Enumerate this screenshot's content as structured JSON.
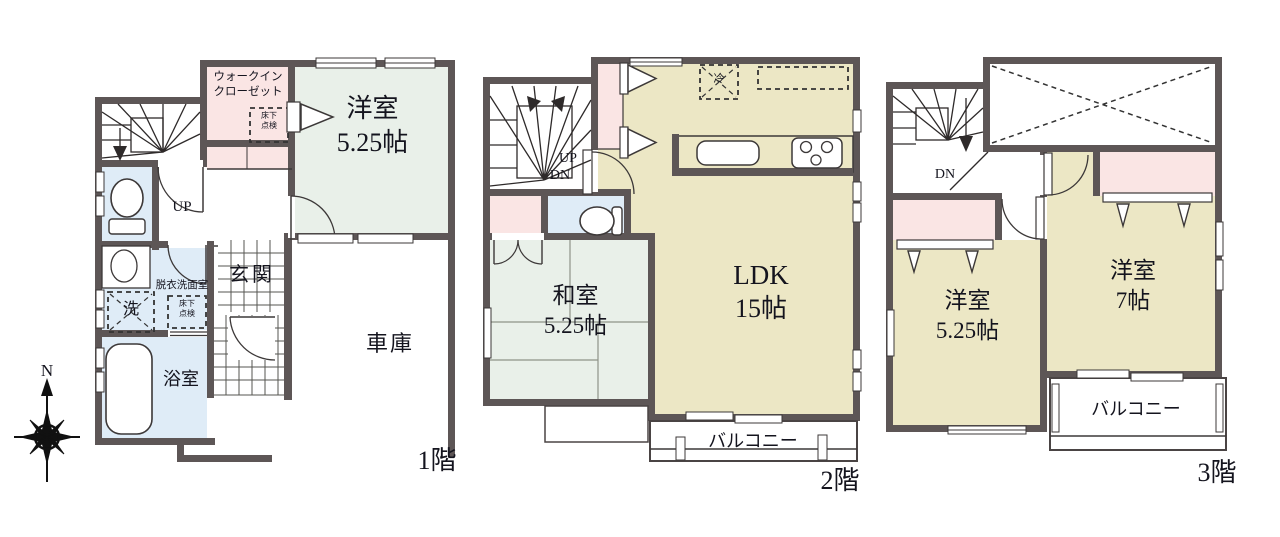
{
  "compass": {
    "north_label": "N"
  },
  "colors": {
    "wall": "#5d5656",
    "room_green": "#e9f0e9",
    "room_beige": "#ece7c5",
    "room_pink": "#fae5e4",
    "room_blue": "#dfecf7",
    "text": "#14141e"
  },
  "floor1": {
    "floor_label": "1階",
    "stairs_label": "UP",
    "walk_in_closet_label": "ウォークイン\nクローゼット",
    "western_room_label": "洋室",
    "western_room_size": "5.25帖",
    "entrance_label": "玄関",
    "garage_label": "車庫",
    "bathroom_label": "浴室",
    "washroom_label": "脱衣洗面室",
    "washing_machine_label": "洗",
    "underfloor_hatch_label": "床下\n点検"
  },
  "floor2": {
    "floor_label": "2階",
    "stairs_up_label": "UP",
    "stairs_down_label": "DN",
    "ldk_label": "LDK",
    "ldk_size": "15帖",
    "japanese_room_label": "和室",
    "japanese_room_size": "5.25帖",
    "balcony_label": "バルコニー",
    "refrigerator_label": "冷"
  },
  "floor3": {
    "floor_label": "3階",
    "stairs_down_label": "DN",
    "western_room_small_label": "洋室",
    "western_room_small_size": "5.25帖",
    "western_room_large_label": "洋室",
    "western_room_large_size": "7帖",
    "balcony_label": "バルコニー"
  }
}
